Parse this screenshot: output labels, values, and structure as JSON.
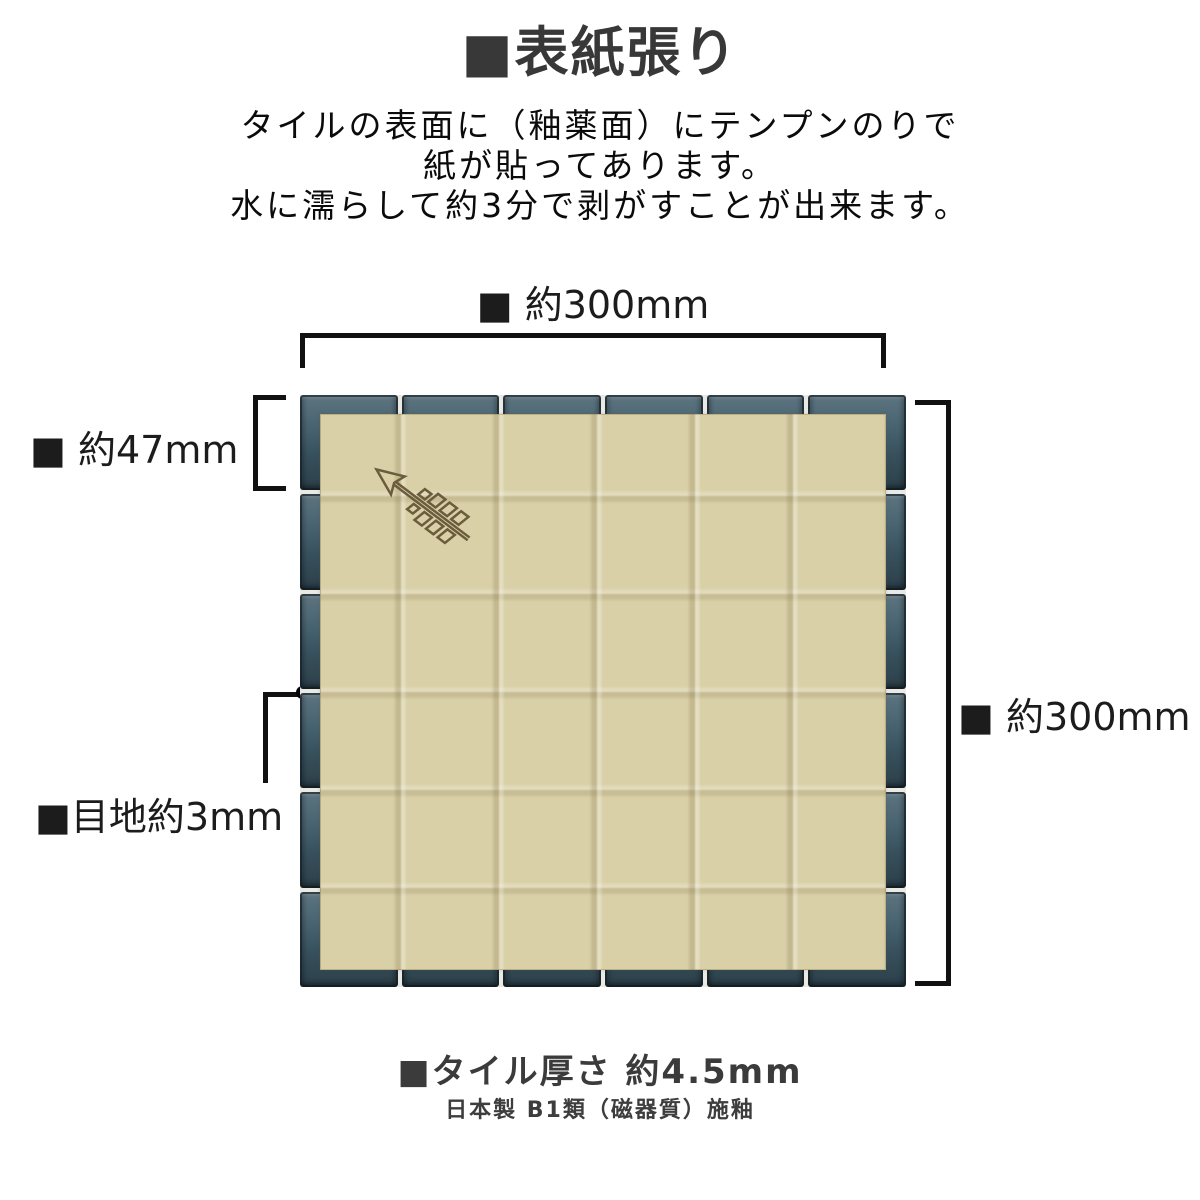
{
  "page": {
    "title": "■表紙張り",
    "description_lines": [
      "タイルの表面に（釉薬面）にテンプンのりで",
      "紙が貼ってあります。",
      "水に濡らして約3分で剥がすことが出来ます。"
    ]
  },
  "diagram": {
    "dimension_labels": {
      "sheet_width_top": "■ 約300mm",
      "tile_size_left": "■ 約47mm",
      "joint_left": "■目地約3mm",
      "sheet_height_right": "■ 約300mm"
    },
    "sheet": {
      "rows": 6,
      "cols": 6
    },
    "icons": {
      "arrow_logo": "arrow-logo"
    },
    "colors": {
      "tile": "#3e5a68",
      "grout": "#ebe9e4",
      "paper": "#d9d0a8",
      "arrow": "#6a5c3c",
      "line": "#000000",
      "title_ink": "#383838",
      "footer_ink": "#3b3b3b"
    }
  },
  "footer": {
    "thickness": "■タイル厚さ 約4.5mm",
    "origin": "日本製 B1類（磁器質）施釉"
  }
}
